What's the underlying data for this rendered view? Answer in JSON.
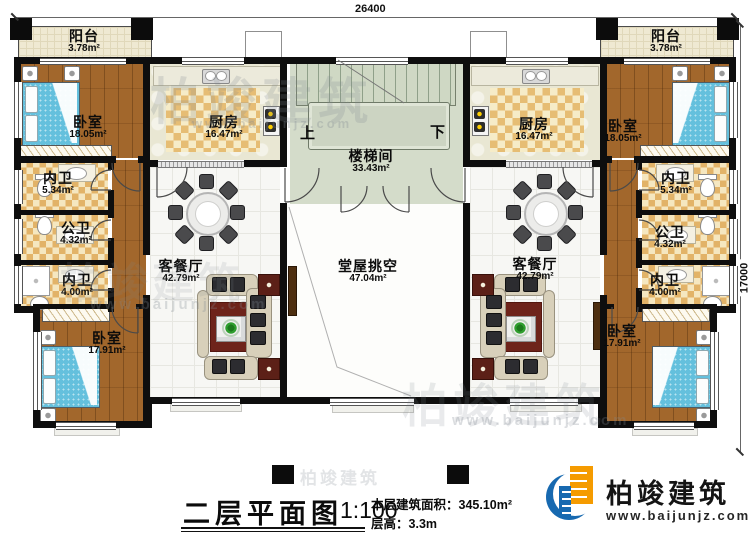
{
  "dimensions": {
    "top_width": "26400",
    "right_height": "17000"
  },
  "rooms": {
    "balcony_left": {
      "name": "阳台",
      "area": "3.78m²"
    },
    "balcony_right": {
      "name": "阳台",
      "area": "3.78m²"
    },
    "bedroom_top_left": {
      "name": "卧室",
      "area": "18.05m²"
    },
    "bedroom_top_right": {
      "name": "卧室",
      "area": "18.05m²"
    },
    "kitchen_left": {
      "name": "厨房",
      "area": "16.47m²"
    },
    "kitchen_right": {
      "name": "厨房",
      "area": "16.47m²"
    },
    "bath_inner_upper_left": {
      "name": "内卫",
      "area": "5.34m²"
    },
    "bath_inner_upper_right": {
      "name": "内卫",
      "area": "5.34m²"
    },
    "bath_public_left": {
      "name": "公卫",
      "area": "4.32m²"
    },
    "bath_public_right": {
      "name": "公卫",
      "area": "4.32m²"
    },
    "bath_inner_lower_left": {
      "name": "内卫",
      "area": "4.00m²"
    },
    "bath_inner_lower_right": {
      "name": "内卫",
      "area": "4.00m²"
    },
    "bedroom_bottom_left": {
      "name": "卧室",
      "area": "17.91m²"
    },
    "bedroom_bottom_right": {
      "name": "卧室",
      "area": "17.91m²"
    },
    "living_dining_left": {
      "name": "客餐厅",
      "area": "42.79m²"
    },
    "living_dining_right": {
      "name": "客餐厅",
      "area": "42.79m²"
    },
    "stairwell": {
      "name": "楼梯间",
      "area": "33.43m²"
    },
    "hall_void": {
      "name": "堂屋挑空",
      "area": "47.04m²"
    }
  },
  "stairs": {
    "up": "上",
    "down": "下"
  },
  "title_block": {
    "title": "二层平面图",
    "scale": "1:100",
    "area_label": "本层建筑面积：",
    "area_value": "345.10m²",
    "height_label": "层高：",
    "height_value": "3.3m"
  },
  "logo": {
    "brand": "柏竣建筑",
    "website": "www.baijunjz.com"
  },
  "watermark": {
    "brand": "柏竣建筑",
    "website": "www.baijunjz.com"
  },
  "colors": {
    "wall": "#0e0e0e",
    "wood_floor": "#a2672c",
    "tile_checker": "#e6bd74",
    "stair_floor": "#d4dcca",
    "bed": "#64c0dd",
    "rug": "#6e241b",
    "logo_blue": "#1769b0",
    "logo_orange": "#f59b00"
  }
}
